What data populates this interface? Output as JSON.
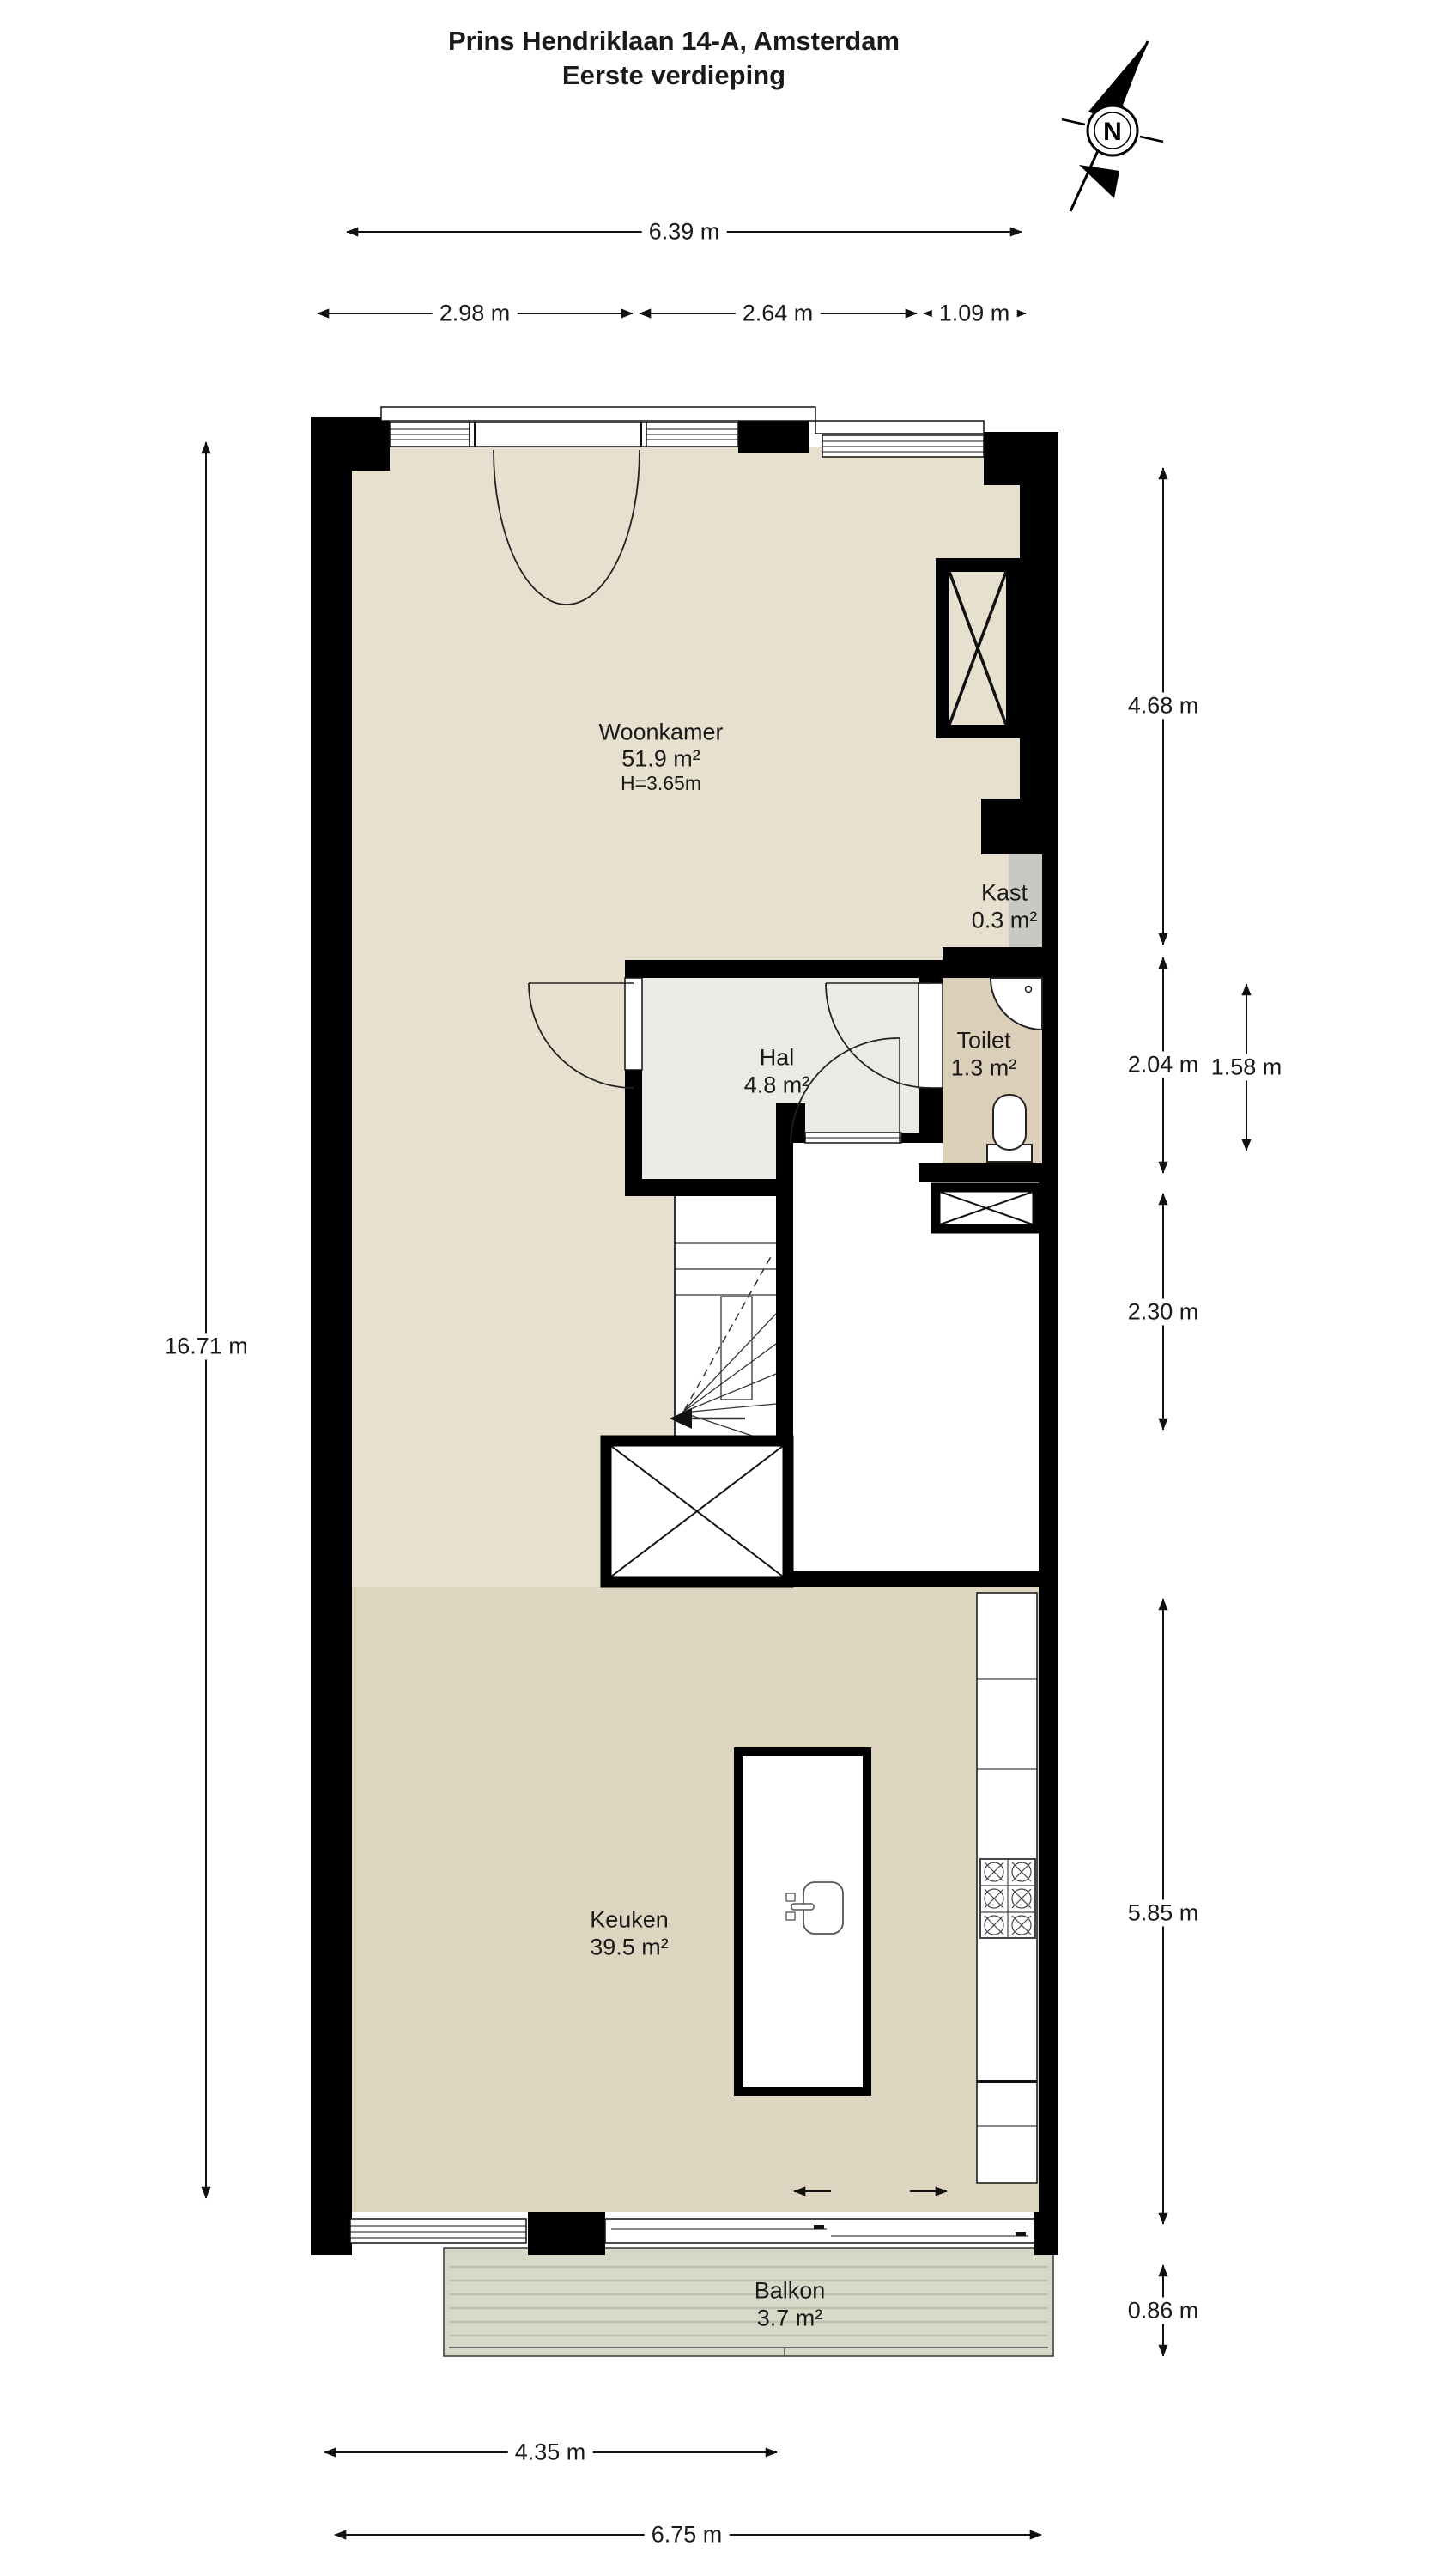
{
  "title": {
    "line1": "Prins Hendriklaan 14-A, Amsterdam",
    "line2": "Eerste verdieping"
  },
  "compass": {
    "label": "N"
  },
  "rooms": {
    "woonkamer": {
      "name": "Woonkamer",
      "area": "51.9 m²",
      "height": "H=3.65m"
    },
    "kast": {
      "name": "Kast",
      "area": "0.3 m²"
    },
    "hal": {
      "name": "Hal",
      "area": "4.8 m²"
    },
    "toilet": {
      "name": "Toilet",
      "area": "1.3 m²"
    },
    "keuken": {
      "name": "Keuken",
      "area": "39.5 m²"
    },
    "balkon": {
      "name": "Balkon",
      "area": "3.7 m²"
    }
  },
  "dimensions": {
    "top_total": "6.39 m",
    "top_left": "2.98 m",
    "top_mid": "2.64 m",
    "top_right": "1.09 m",
    "left_total": "16.71 m",
    "right_woonkamer": "4.68 m",
    "right_toilet_section": "2.04 m",
    "right_toilet": "1.58 m",
    "right_stairs": "2.30 m",
    "right_keuken": "5.85 m",
    "right_balkon": "0.86 m",
    "bottom_inner": "4.35 m",
    "bottom_total": "6.75 m"
  },
  "colors": {
    "wall": "#000000",
    "line": "#1a1a1a",
    "living": "#e8e0cf",
    "kitchen": "#ded5c1",
    "hal": "#ebeae4",
    "toilet": "#dccfba",
    "kast": "#c9c9c3",
    "balcony": "#d8d8c9",
    "balcony_stripe": "#c0c0af"
  }
}
